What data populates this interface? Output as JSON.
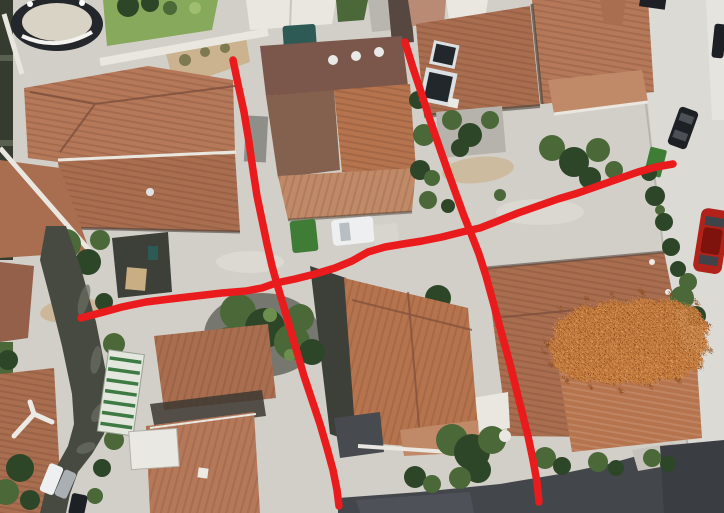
{
  "scene": {
    "type": "satellite-aerial-photo",
    "subject": "Aerial view of a residential block: terracotta tiled roofs, courtyards, a dark alley on the left, a street with parked cars on the right, a small pool top-left; hand-drawn red annotation lines and an orange spray mark overlay the photo",
    "palette": {
      "courtyard": "#d2cfc8",
      "street": "#dcdad5",
      "sidewalk": "#e6e4de",
      "roof_salmon": "#b5795a",
      "roof_mid": "#a96e50",
      "roof_bright": "#b5744e",
      "roof_pale": "#c08a68",
      "roof_maroon": "#7b564a",
      "roof_deep": "#95604a",
      "ridge_dark": "#7d4f3c",
      "wall_white": "#e9e7e0",
      "shadow_dark": "#3d3f39",
      "dark_band": "#43464b",
      "alley": "#474a41",
      "hedge_dark": "#353b2f",
      "vegetation": "#4b6838",
      "vegetation_dark": "#2e4628",
      "lawn": "#86a95b",
      "dirt": "#c9ae84",
      "pool_ring": "#23262a",
      "pool_inner": "#d9d3c6",
      "teal_tarp": "#2e5a55",
      "greenhouse_green": "#3e7a44",
      "car_red": "#b1221a",
      "car_black": "#1d2125",
      "car_white": "#edeff0",
      "car_gray": "#a9afb2",
      "dumpster_green": "#3f7c36",
      "solar_panel": "#22272b"
    },
    "annotations": {
      "color": "#ea1b1d",
      "stroke_width": 7.5,
      "lines": [
        {
          "name": "annotation-line-vertical-left",
          "points": [
            [
              233,
              60
            ],
            [
              238,
              84
            ],
            [
              244,
              112
            ],
            [
              249,
              142
            ],
            [
              253,
              170
            ],
            [
              257,
              196
            ],
            [
              262,
              220
            ],
            [
              267,
              244
            ],
            [
              272,
              266
            ],
            [
              277,
              284
            ],
            [
              283,
              304
            ],
            [
              290,
              328
            ],
            [
              297,
              352
            ],
            [
              304,
              376
            ],
            [
              312,
              400
            ],
            [
              320,
              424
            ],
            [
              327,
              448
            ],
            [
              333,
              470
            ],
            [
              337,
              490
            ],
            [
              339,
              506
            ]
          ]
        },
        {
          "name": "annotation-line-vertical-right",
          "points": [
            [
              405,
              42
            ],
            [
              413,
              68
            ],
            [
              421,
              92
            ],
            [
              429,
              117
            ],
            [
              438,
              143
            ],
            [
              447,
              169
            ],
            [
              456,
              194
            ],
            [
              464,
              216
            ],
            [
              472,
              236
            ],
            [
              479,
              254
            ],
            [
              486,
              276
            ],
            [
              492,
              298
            ],
            [
              498,
              320
            ],
            [
              504,
              342
            ],
            [
              510,
              364
            ],
            [
              516,
              388
            ],
            [
              522,
              412
            ],
            [
              528,
              436
            ],
            [
              533,
              460
            ],
            [
              537,
              482
            ],
            [
              539,
              502
            ]
          ]
        },
        {
          "name": "annotation-line-horizontal",
          "points": [
            [
              81,
              318
            ],
            [
              100,
              313
            ],
            [
              122,
              307
            ],
            [
              146,
              302
            ],
            [
              170,
              299
            ],
            [
              196,
              296
            ],
            [
              222,
              293
            ],
            [
              246,
              291
            ],
            [
              262,
              288
            ],
            [
              276,
              283
            ],
            [
              295,
              279
            ],
            [
              315,
              274
            ],
            [
              335,
              268
            ],
            [
              352,
              261
            ],
            [
              368,
              252
            ],
            [
              385,
              247
            ],
            [
              403,
              244
            ],
            [
              422,
              241
            ],
            [
              442,
              237
            ],
            [
              462,
              232
            ],
            [
              480,
              228
            ],
            [
              498,
              221
            ],
            [
              518,
              213
            ],
            [
              538,
              206
            ],
            [
              558,
              199
            ],
            [
              578,
              193
            ],
            [
              598,
              186
            ],
            [
              618,
              179
            ],
            [
              638,
              172
            ],
            [
              656,
              167
            ],
            [
              673,
              164
            ]
          ]
        }
      ],
      "spray": {
        "name": "spray-mark-orange",
        "base_color": "#c9803f",
        "dot_colors": [
          "#8a4a1a",
          "#e8a667"
        ],
        "path": "M553,334 C550,324 556,315 567,313 C571,305 583,301 593,305 C600,298 614,296 624,301 C632,295 646,294 654,299 C663,295 676,297 682,303 C691,302 699,308 700,316 C707,320 708,329 703,335 C708,341 706,350 699,353 C703,361 697,369 687,368 C683,376 670,380 660,376 C652,383 636,384 626,378 C616,384 600,383 592,377 C582,381 568,378 562,370 C553,368 547,360 550,351 C544,346 545,338 553,334 Z",
        "scatter_dots": [
          [
            545,
            342,
            2
          ],
          [
            558,
            306,
            2
          ],
          [
            584,
            296,
            2.5
          ],
          [
            610,
            292,
            2
          ],
          [
            640,
            290,
            2.5
          ],
          [
            668,
            292,
            2
          ],
          [
            694,
            300,
            2.5
          ],
          [
            706,
            322,
            2
          ],
          [
            708,
            348,
            2.5
          ],
          [
            698,
            364,
            2
          ],
          [
            676,
            378,
            2.5
          ],
          [
            648,
            384,
            2
          ],
          [
            618,
            388,
            2.5
          ],
          [
            588,
            384,
            2
          ],
          [
            564,
            378,
            2.5
          ],
          [
            548,
            362,
            2
          ],
          [
            542,
            350,
            2
          ]
        ]
      }
    }
  }
}
